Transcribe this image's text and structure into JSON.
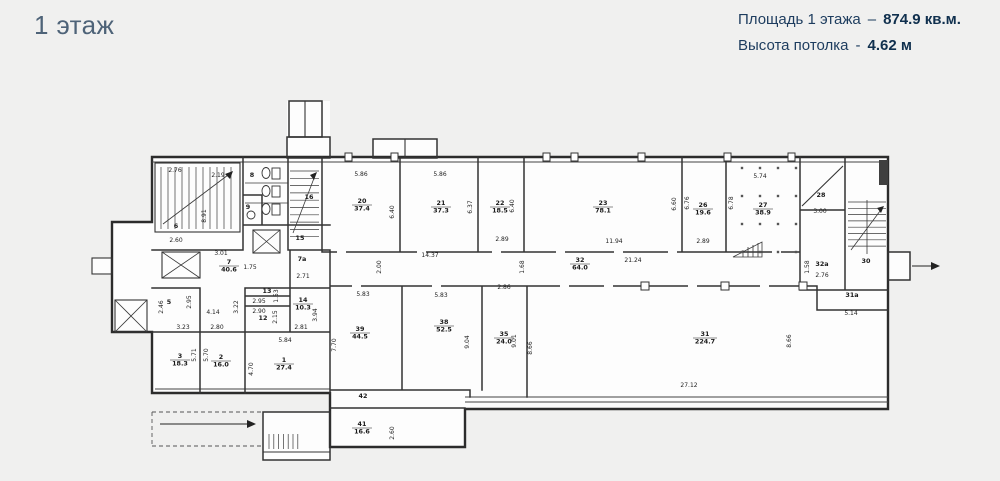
{
  "header": {
    "title": "1 этаж",
    "area_label": "Площадь 1 этажа",
    "area_sep": "–",
    "area_value": "874.9 кв.м.",
    "height_label": "Высота потолка",
    "height_sep": "-",
    "height_value": "4.62 м"
  },
  "colors": {
    "accent": "#1d3c5e",
    "title": "#4e6378",
    "background": "#f0f0ef",
    "wall": "#2c2c2c"
  },
  "plan": {
    "rooms": [
      {
        "n": "1",
        "a": "27.4",
        "x": 284,
        "y": 362
      },
      {
        "n": "2",
        "a": "16.0",
        "x": 221,
        "y": 359
      },
      {
        "n": "3",
        "a": "18.3",
        "x": 180,
        "y": 358
      },
      {
        "n": "5",
        "a": "",
        "x": 169,
        "y": 304
      },
      {
        "n": "6",
        "a": "",
        "x": 176,
        "y": 228
      },
      {
        "n": "7",
        "a": "40.6",
        "x": 229,
        "y": 264
      },
      {
        "n": "7а",
        "a": "",
        "x": 302,
        "y": 261
      },
      {
        "n": "8",
        "a": "",
        "x": 252,
        "y": 177
      },
      {
        "n": "9",
        "a": "",
        "x": 248,
        "y": 209
      },
      {
        "n": "12",
        "a": "",
        "x": 263,
        "y": 320
      },
      {
        "n": "13",
        "a": "",
        "x": 267,
        "y": 293
      },
      {
        "n": "14",
        "a": "10.3",
        "x": 303,
        "y": 302
      },
      {
        "n": "15",
        "a": "",
        "x": 300,
        "y": 240
      },
      {
        "n": "16",
        "a": "",
        "x": 309,
        "y": 199
      },
      {
        "n": "20",
        "a": "37.4",
        "x": 362,
        "y": 203
      },
      {
        "n": "21",
        "a": "37.3",
        "x": 441,
        "y": 205
      },
      {
        "n": "22",
        "a": "18.5",
        "x": 500,
        "y": 205
      },
      {
        "n": "23",
        "a": "78.1",
        "x": 603,
        "y": 205
      },
      {
        "n": "26",
        "a": "19.6",
        "x": 703,
        "y": 207
      },
      {
        "n": "27",
        "a": "38.9",
        "x": 763,
        "y": 207
      },
      {
        "n": "28",
        "a": "",
        "x": 821,
        "y": 197
      },
      {
        "n": "30",
        "a": "",
        "x": 866,
        "y": 263
      },
      {
        "n": "31",
        "a": "224.7",
        "x": 705,
        "y": 336
      },
      {
        "n": "31а",
        "a": "",
        "x": 852,
        "y": 297
      },
      {
        "n": "32",
        "a": "64.0",
        "x": 580,
        "y": 262
      },
      {
        "n": "32а",
        "a": "",
        "x": 822,
        "y": 266
      },
      {
        "n": "35",
        "a": "24.0",
        "x": 504,
        "y": 336
      },
      {
        "n": "38",
        "a": "52.5",
        "x": 444,
        "y": 324
      },
      {
        "n": "39",
        "a": "44.5",
        "x": 360,
        "y": 331
      },
      {
        "n": "41",
        "a": "16.6",
        "x": 362,
        "y": 426
      },
      {
        "n": "42",
        "a": "",
        "x": 363,
        "y": 398
      }
    ],
    "dims": [
      {
        "t": "2.76",
        "x": 175,
        "y": 172,
        "r": 0
      },
      {
        "t": "2.19",
        "x": 218,
        "y": 177,
        "r": 0
      },
      {
        "t": "8.91",
        "x": 206,
        "y": 216,
        "r": 1
      },
      {
        "t": "2.60",
        "x": 176,
        "y": 242,
        "r": 0
      },
      {
        "t": "3.01",
        "x": 221,
        "y": 255,
        "r": 0
      },
      {
        "t": "1.75",
        "x": 250,
        "y": 269,
        "r": 0
      },
      {
        "t": "2.71",
        "x": 303,
        "y": 278,
        "r": 0
      },
      {
        "t": "2.46",
        "x": 163,
        "y": 307,
        "r": 1
      },
      {
        "t": "2.95",
        "x": 191,
        "y": 302,
        "r": 1
      },
      {
        "t": "4.14",
        "x": 213,
        "y": 314,
        "r": 0
      },
      {
        "t": "3.23",
        "x": 183,
        "y": 329,
        "r": 0
      },
      {
        "t": "2.80",
        "x": 217,
        "y": 329,
        "r": 0
      },
      {
        "t": "5.71",
        "x": 196,
        "y": 355,
        "r": 1
      },
      {
        "t": "5.70",
        "x": 208,
        "y": 355,
        "r": 1
      },
      {
        "t": "3.22",
        "x": 238,
        "y": 307,
        "r": 1
      },
      {
        "t": "4.70",
        "x": 253,
        "y": 369,
        "r": 1
      },
      {
        "t": "5.84",
        "x": 285,
        "y": 342,
        "r": 0
      },
      {
        "t": "1.53",
        "x": 278,
        "y": 296,
        "r": 1
      },
      {
        "t": "2.95",
        "x": 259,
        "y": 303,
        "r": 0
      },
      {
        "t": "2.90",
        "x": 259,
        "y": 313,
        "r": 0
      },
      {
        "t": "2.15",
        "x": 277,
        "y": 317,
        "r": 1
      },
      {
        "t": "3.94",
        "x": 317,
        "y": 315,
        "r": 1
      },
      {
        "t": "2.81",
        "x": 301,
        "y": 329,
        "r": 0
      },
      {
        "t": "5.86",
        "x": 361,
        "y": 176,
        "r": 0
      },
      {
        "t": "5.86",
        "x": 440,
        "y": 176,
        "r": 0
      },
      {
        "t": "6.40",
        "x": 394,
        "y": 212,
        "r": 1
      },
      {
        "t": "6.37",
        "x": 472,
        "y": 207,
        "r": 1
      },
      {
        "t": "6.40",
        "x": 514,
        "y": 206,
        "r": 1
      },
      {
        "t": "2.89",
        "x": 502,
        "y": 241,
        "r": 0
      },
      {
        "t": "14.37",
        "x": 430,
        "y": 257,
        "r": 0
      },
      {
        "t": "2.00",
        "x": 381,
        "y": 267,
        "r": 1
      },
      {
        "t": "1.68",
        "x": 524,
        "y": 267,
        "r": 1
      },
      {
        "t": "11.94",
        "x": 614,
        "y": 243,
        "r": 0
      },
      {
        "t": "21.24",
        "x": 633,
        "y": 262,
        "r": 0
      },
      {
        "t": "6.60",
        "x": 676,
        "y": 204,
        "r": 1
      },
      {
        "t": "6.76",
        "x": 689,
        "y": 203,
        "r": 1
      },
      {
        "t": "2.89",
        "x": 703,
        "y": 243,
        "r": 0
      },
      {
        "t": "6.78",
        "x": 733,
        "y": 203,
        "r": 1
      },
      {
        "t": "5.74",
        "x": 760,
        "y": 178,
        "r": 0
      },
      {
        "t": "3.00",
        "x": 820,
        "y": 213,
        "r": 0
      },
      {
        "t": "1.58",
        "x": 809,
        "y": 267,
        "r": 1
      },
      {
        "t": "2.76",
        "x": 822,
        "y": 277,
        "r": 0
      },
      {
        "t": "5.14",
        "x": 851,
        "y": 315,
        "r": 0
      },
      {
        "t": "5.83",
        "x": 363,
        "y": 296,
        "r": 0
      },
      {
        "t": "5.83",
        "x": 441,
        "y": 297,
        "r": 0
      },
      {
        "t": "2.86",
        "x": 504,
        "y": 289,
        "r": 0
      },
      {
        "t": "7.70",
        "x": 336,
        "y": 345,
        "r": 1
      },
      {
        "t": "9.04",
        "x": 469,
        "y": 342,
        "r": 1
      },
      {
        "t": "9.01",
        "x": 516,
        "y": 341,
        "r": 1
      },
      {
        "t": "8.66",
        "x": 532,
        "y": 348,
        "r": 1
      },
      {
        "t": "8.66",
        "x": 791,
        "y": 341,
        "r": 1
      },
      {
        "t": "27.12",
        "x": 689,
        "y": 387,
        "r": 0
      },
      {
        "t": "2.60",
        "x": 394,
        "y": 433,
        "r": 1
      }
    ]
  }
}
